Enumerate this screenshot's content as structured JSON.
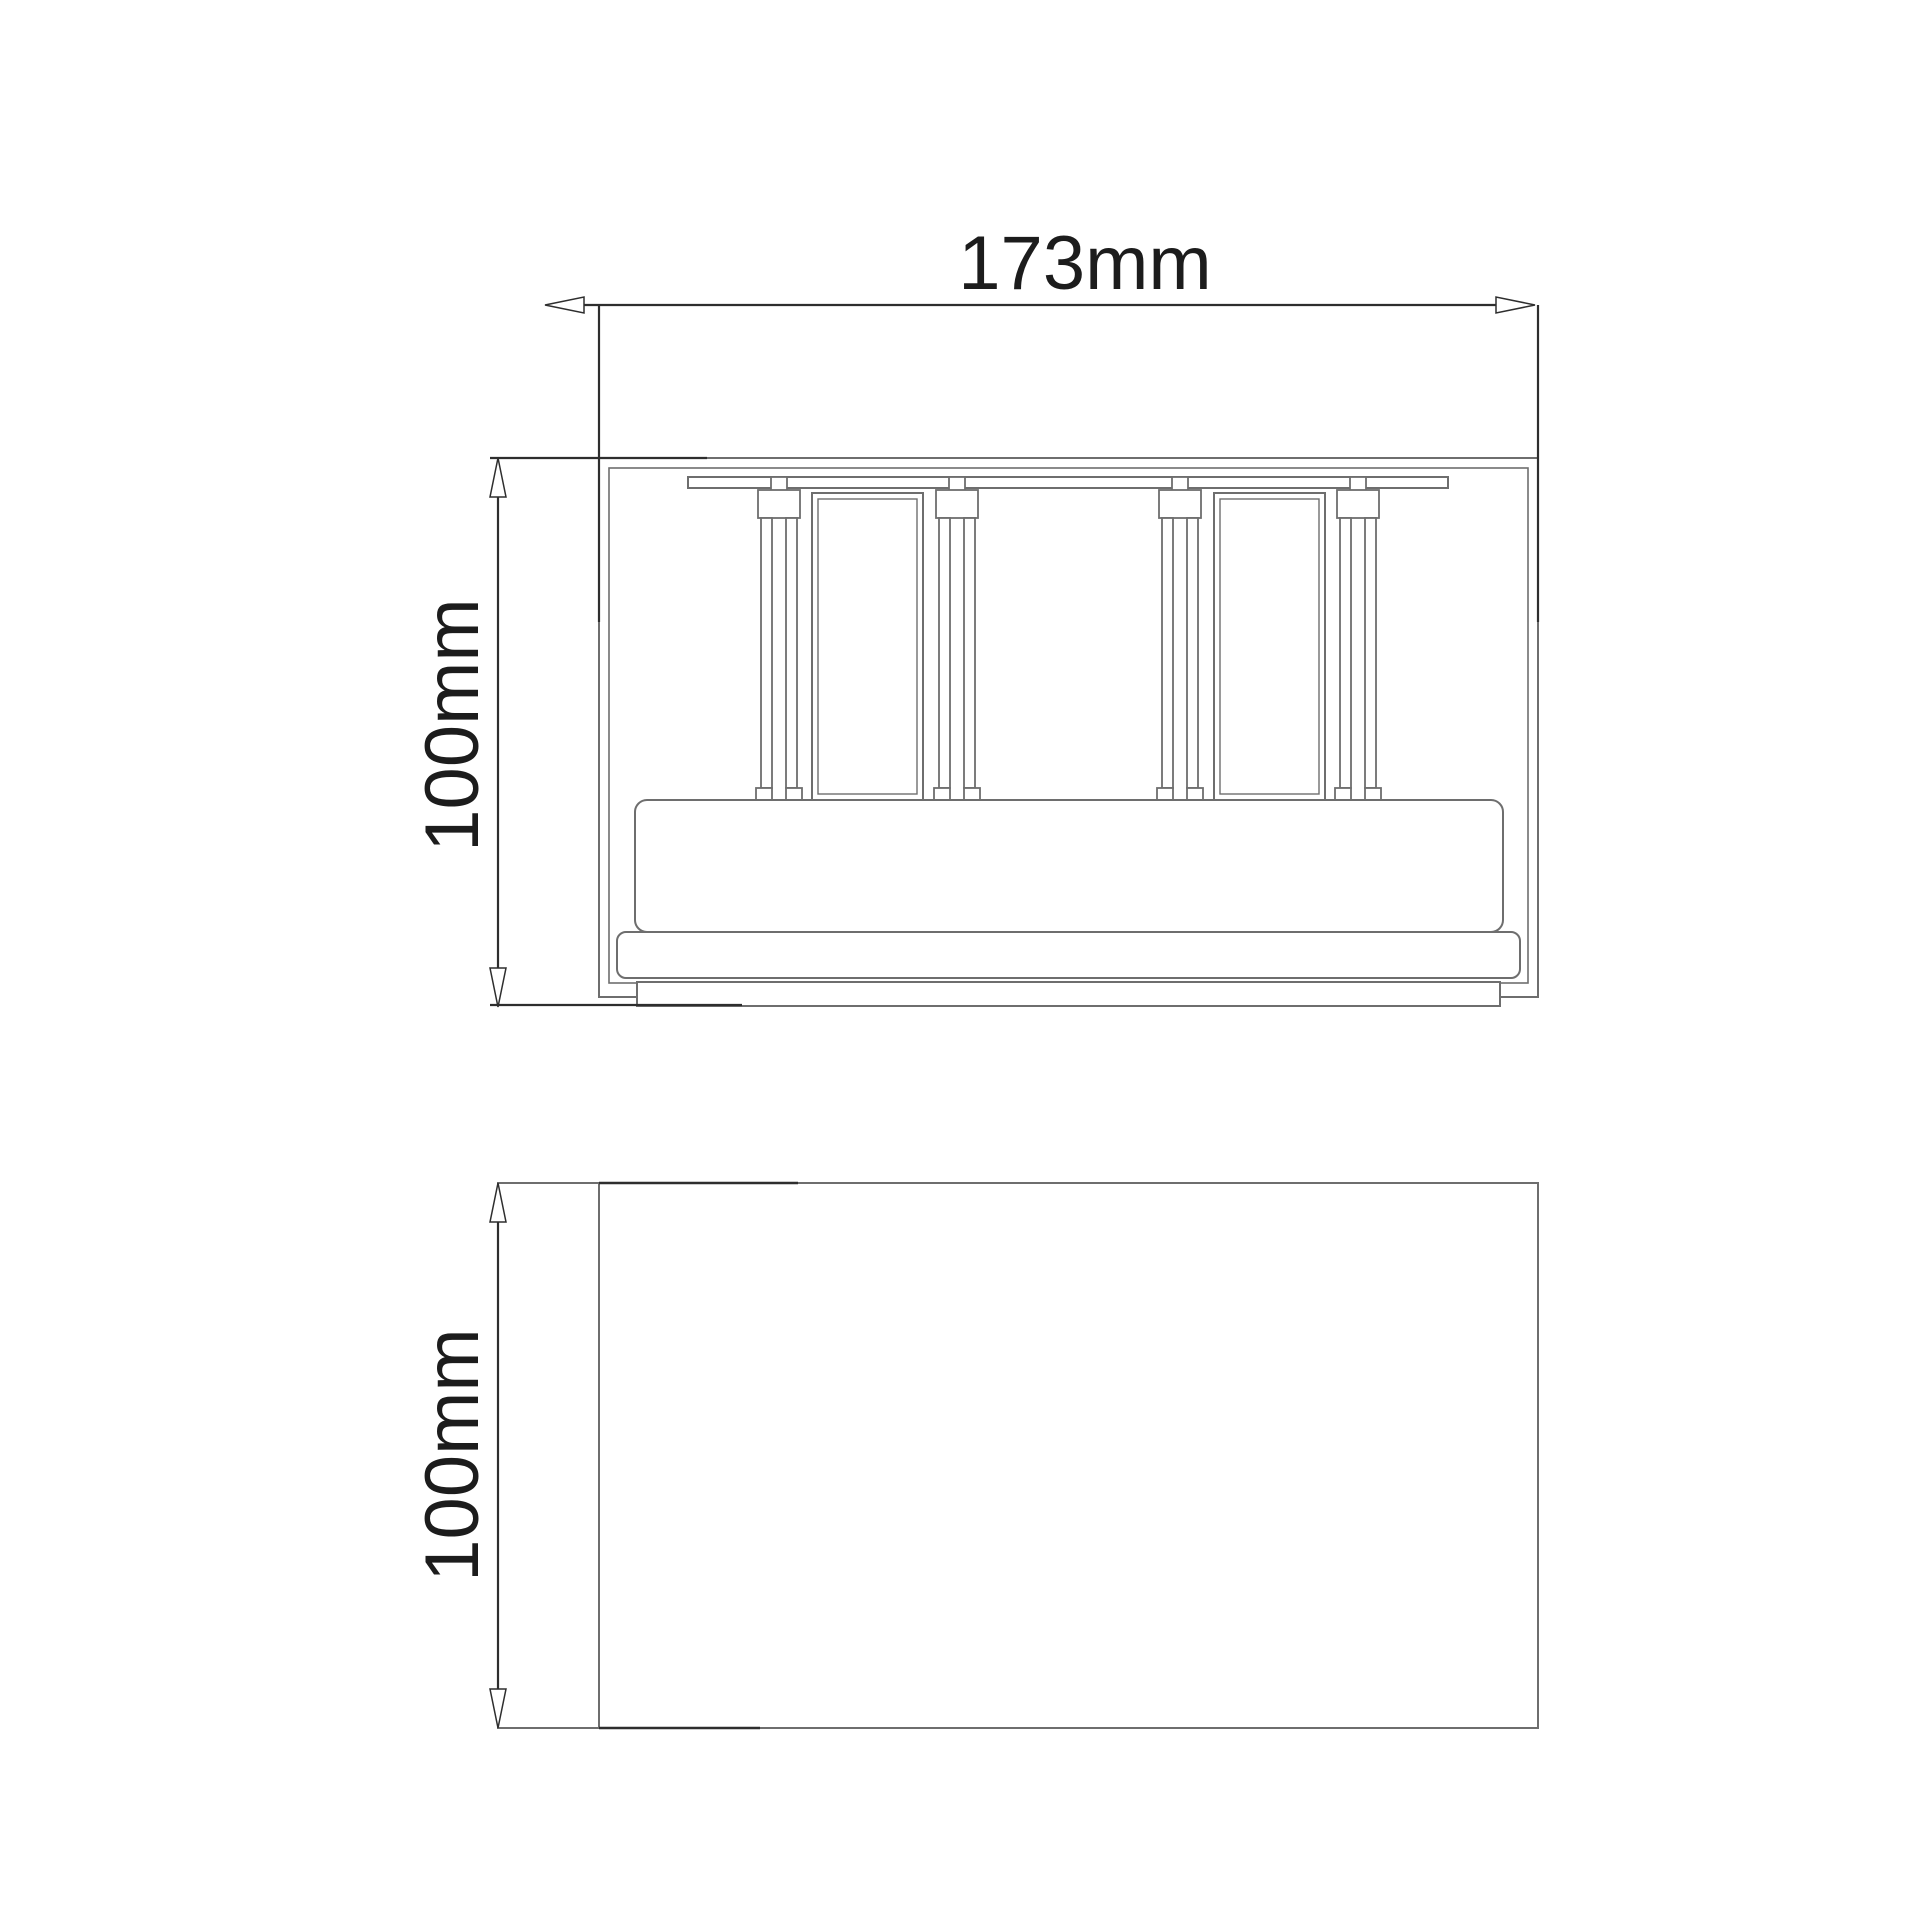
{
  "page": {
    "background": "#ffffff"
  },
  "drawing": {
    "views": {
      "front": {
        "width_label": "173mm",
        "height_label": "100mm"
      },
      "side": {
        "height_label": "100mm"
      }
    },
    "colors": {
      "object_line": "#6e6e6e",
      "dimension_line": "#2e2e2e",
      "label_text": "#1c1c1c",
      "background": "#ffffff"
    }
  }
}
